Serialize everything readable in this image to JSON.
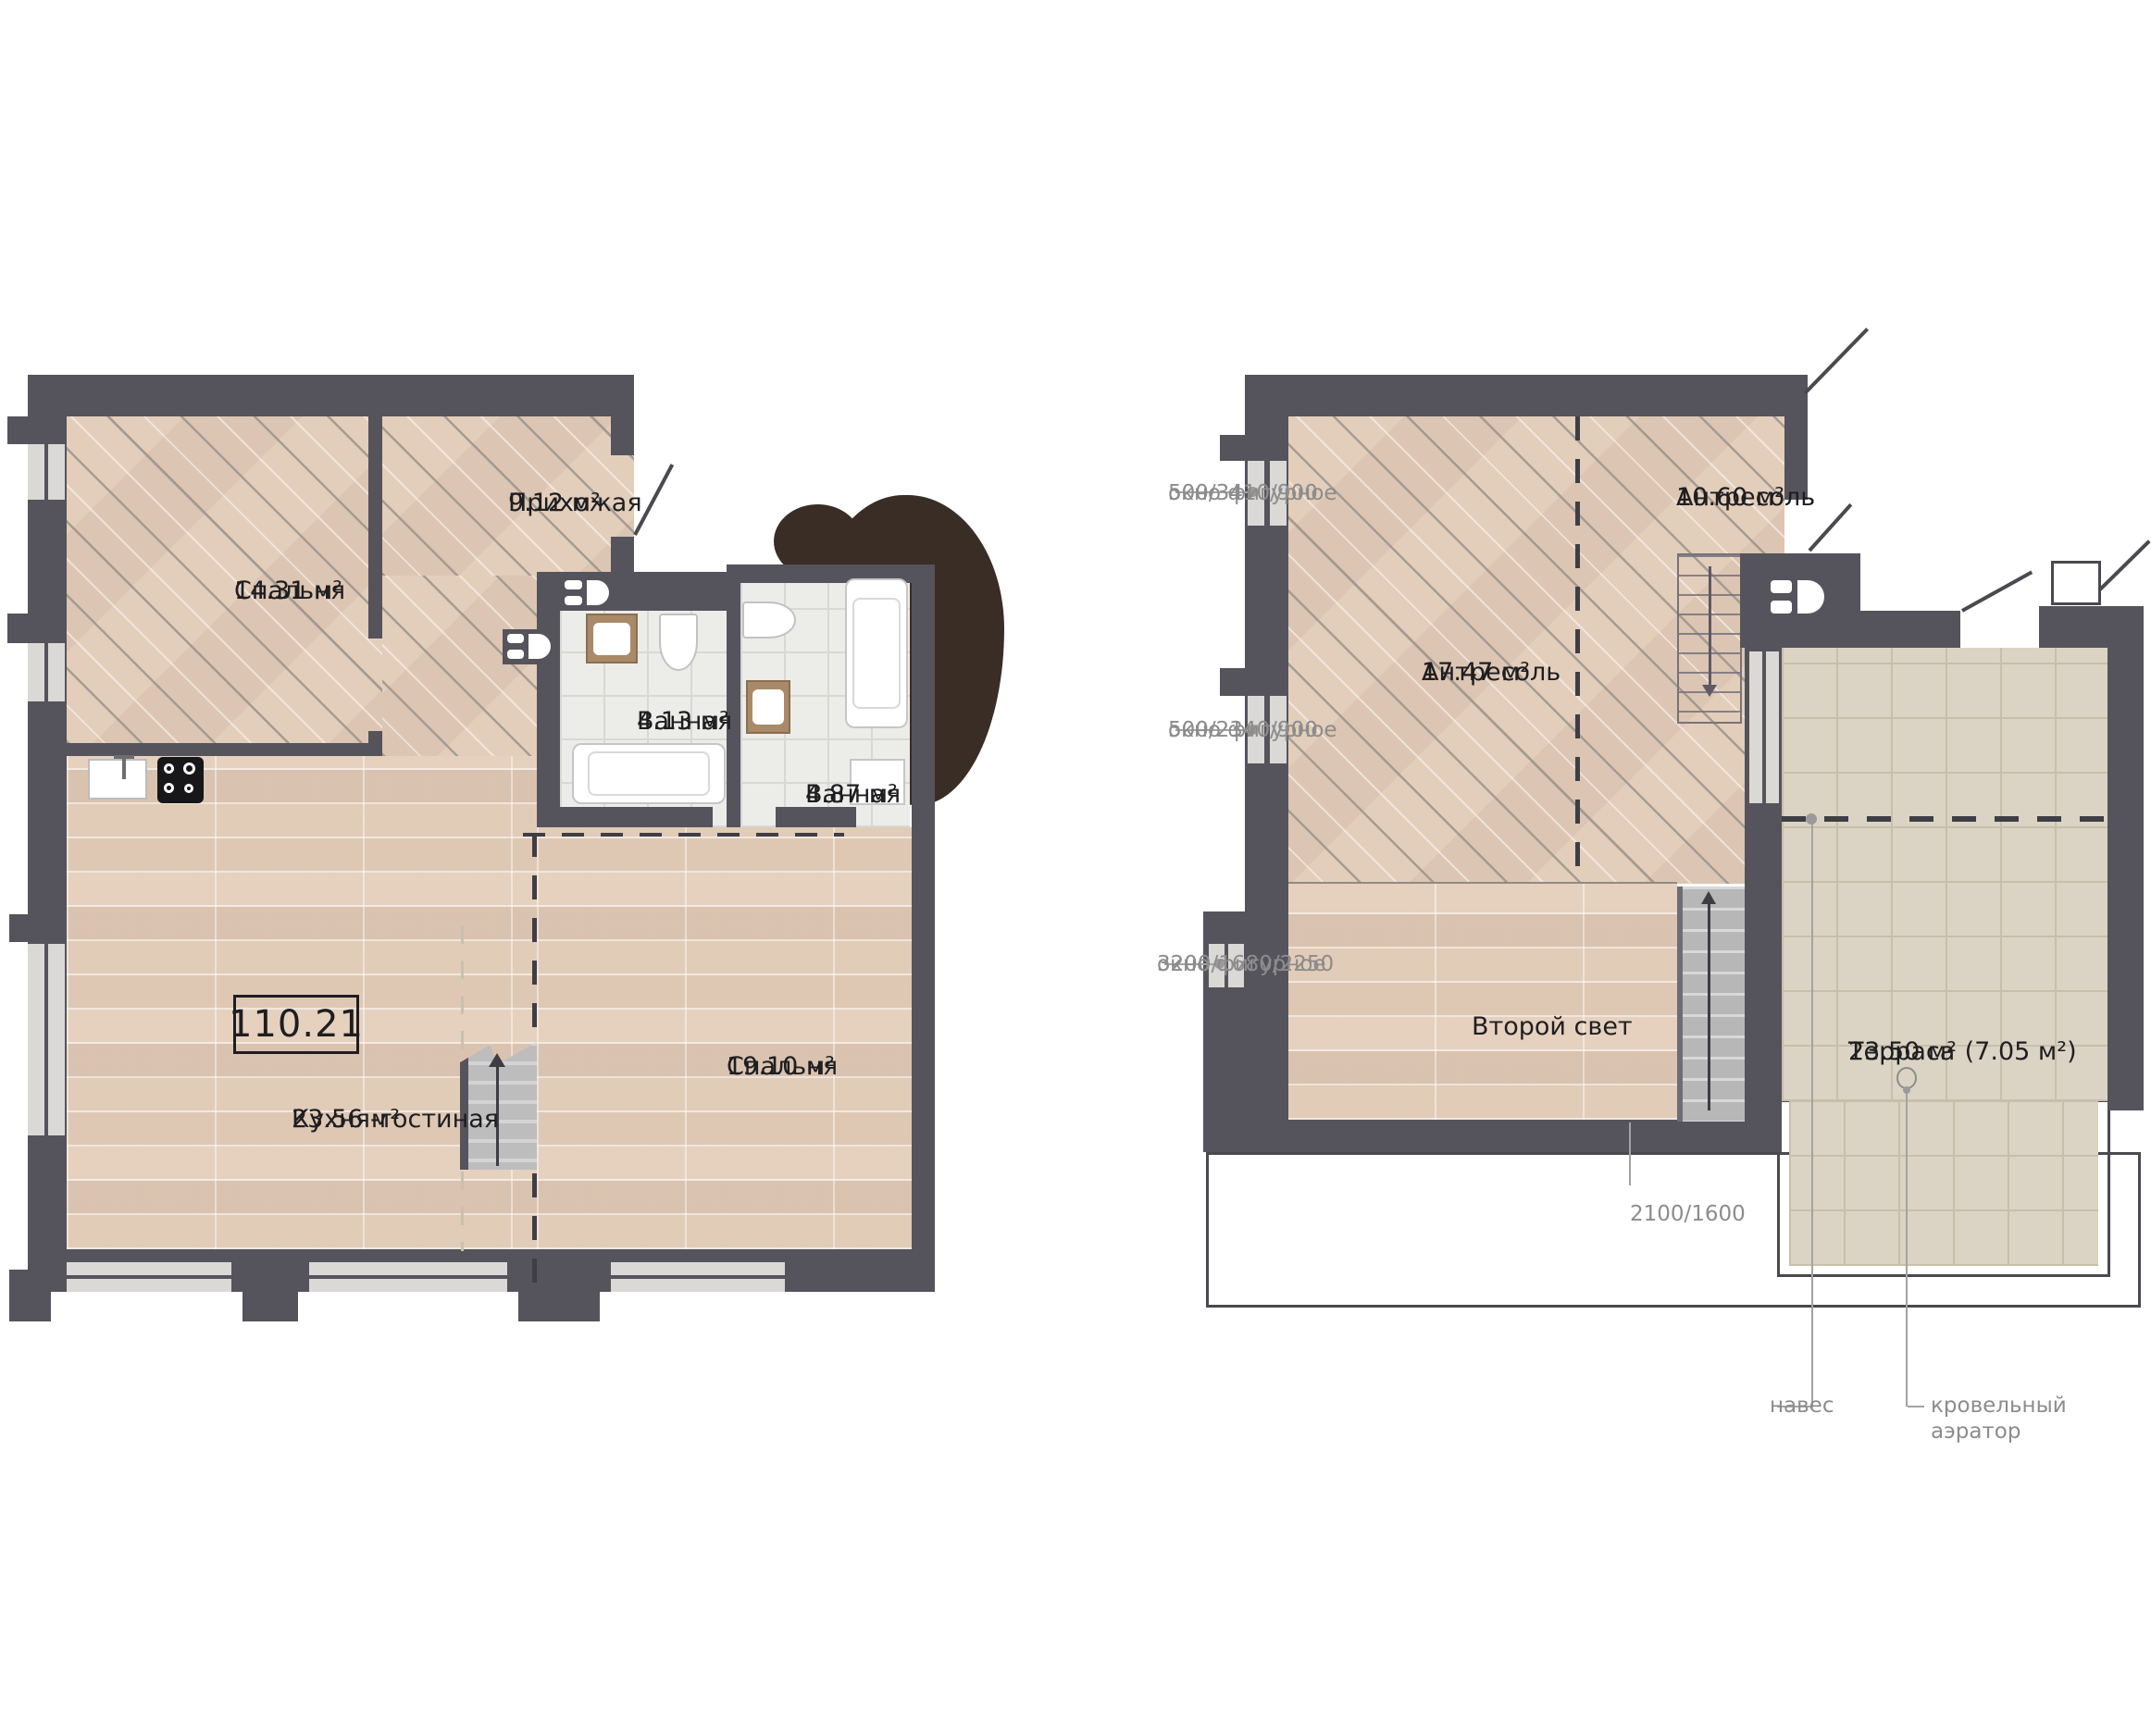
{
  "colors": {
    "wall": "#55535C",
    "wood_floor": "#E7D3C1",
    "bath_tile": "#ECECE9",
    "terrace_tile": "#DBD4C4",
    "window": "#DAD9D5",
    "tree_blob": "#3A2D26",
    "label_text": "#1E1E21",
    "annotation_text": "#8C8C8C"
  },
  "floor1": {
    "total_area": "110.21",
    "rooms": [
      {
        "name": "Спальня",
        "area": "14.31 м²"
      },
      {
        "name": "Прихожая",
        "area": "9.12 м²"
      },
      {
        "name": "Ванная",
        "area": "4.13 м²"
      },
      {
        "name": "Ванная",
        "area": "4.87 м²"
      },
      {
        "name": "Кухня-гостиная",
        "area": "23.56 м²"
      },
      {
        "name": "Спальня",
        "area": "19.10 м²"
      }
    ]
  },
  "floor2": {
    "rooms": [
      {
        "name": "Антресоль",
        "area": "17.47 м²"
      },
      {
        "name": "Антресоль",
        "area": "10.60 м²"
      }
    ],
    "second_light": "Второй свет",
    "terrace": {
      "name": "Терраса",
      "area": "23.50 м² (7.05 м²)"
    }
  },
  "annotations": {
    "window_type": "окно фигурное",
    "window1": "500/3410/900",
    "window2": "500/2340/900",
    "window3": "3200/1680/2250",
    "opening": "2100/1600",
    "canopy": "навес",
    "aerator": "кровельный аэратор"
  }
}
